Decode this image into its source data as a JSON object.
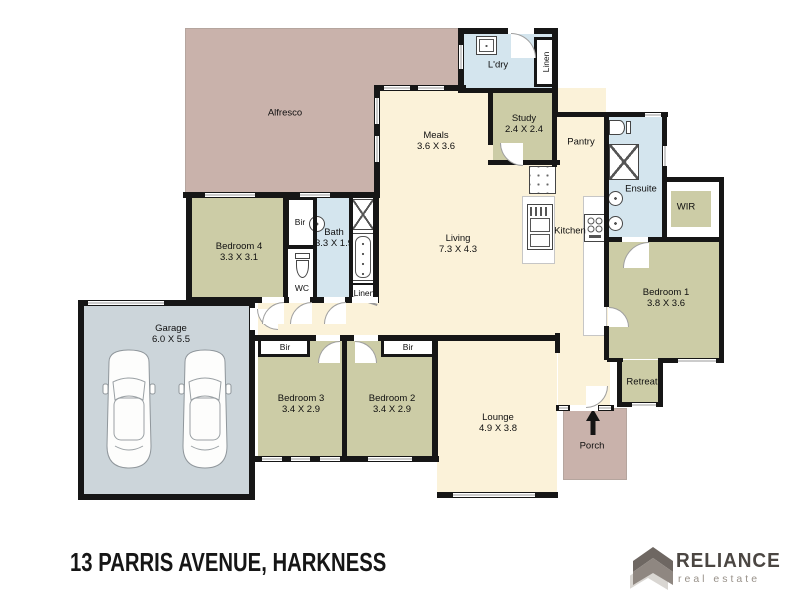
{
  "colors": {
    "wall": "#161616",
    "floor": "#fbf2d9",
    "bedroom": "#cccca6",
    "wet": "#d4e5ee",
    "outdoor": "#c9b2ab",
    "garage": "#ccd5da",
    "line": "#b5a59e",
    "brand-dark": "#4b4642",
    "brand-light": "#989189",
    "logo-roof": "#6e6762",
    "logo-body": "#8f8781",
    "logo-shadow": "#d9d6d2"
  },
  "rooms": {
    "alfresco": {
      "label": "Alfresco"
    },
    "meals": {
      "label": "Meals",
      "dims": "3.6 X 3.6"
    },
    "living": {
      "label": "Living",
      "dims": "7.3 X 4.3"
    },
    "kitchen": {
      "label": "Kitchen"
    },
    "ldry": {
      "label": "L'dry"
    },
    "linen_top": {
      "label": "Linen"
    },
    "study": {
      "label": "Study",
      "dims": "2.4 X 2.4"
    },
    "pantry": {
      "label": "Pantry"
    },
    "ensuite": {
      "label": "Ensuite"
    },
    "wir": {
      "label": "WIR"
    },
    "bedroom1": {
      "label": "Bedroom 1",
      "dims": "3.8 X 3.6"
    },
    "retreat": {
      "label": "Retreat"
    },
    "porch": {
      "label": "Porch"
    },
    "lounge": {
      "label": "Lounge",
      "dims": "4.9 X 3.8"
    },
    "bedroom2": {
      "label": "Bedroom 2",
      "dims": "3.4 X 2.9"
    },
    "bedroom3": {
      "label": "Bedroom 3",
      "dims": "3.4 X 2.9"
    },
    "garage": {
      "label": "Garage",
      "dims": "6.0 X 5.5"
    },
    "bedroom4": {
      "label": "Bedroom 4",
      "dims": "3.3 X 3.1"
    },
    "bath": {
      "label": "Bath",
      "dims": "3.3 X 1.9"
    },
    "wc": {
      "label": "WC"
    },
    "bir_bath": {
      "label": "Bir"
    },
    "linen_bath": {
      "label": "Linen"
    },
    "bir_bed3": {
      "label": "Bir"
    },
    "bir_bed2": {
      "label": "Bir"
    }
  },
  "footer": {
    "address": "13 PARRIS AVENUE, HARKNESS",
    "brand": "RELIANCE",
    "tagline": "real estate"
  }
}
